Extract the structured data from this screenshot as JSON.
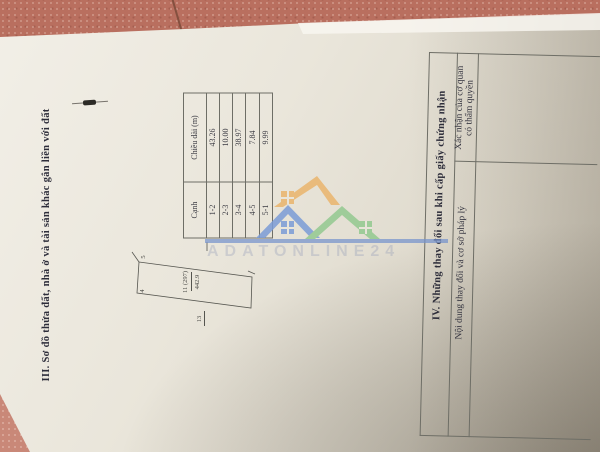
{
  "section_iii": {
    "heading": "III. Sơ đồ thửa đất, nhà ở và tài sản khác gắn liền với đất",
    "table": {
      "col_headers": [
        "Cạnh",
        "Chiều dài (m)"
      ],
      "rows": [
        [
          "1-2",
          "43.26"
        ],
        [
          "2-3",
          "10.00"
        ],
        [
          "3-4",
          "38.97"
        ],
        [
          "4-5",
          "7.84"
        ],
        [
          "5-1",
          "9.99"
        ]
      ]
    },
    "diagram": {
      "parcel_label": "11 (297)",
      "parcel_area": "442.9",
      "adjacent_parcel": "13",
      "vertex_4": "4",
      "vertex_5": "5"
    }
  },
  "section_iv": {
    "heading": "IV. Những thay đổi sau khi cấp giấy chứng nhận",
    "column_1_header": "Nội dung thay đổi và cơ sở pháp lý",
    "column_2_header_line_1": "Xác nhận của cơ quan",
    "column_2_header_line_2": "có thẩm quyền"
  },
  "watermark": {
    "text": "ADATONLINE24",
    "colors": {
      "blue": "#7b9cd6",
      "orange": "#eab56d",
      "green": "#93c990",
      "bar": "#7693cc"
    }
  },
  "colors": {
    "tile": "#b96f5f",
    "tile_corner": "#c98878",
    "paper": "#e9e5da",
    "ink": "#32323c",
    "table_line": "#6e6e66"
  }
}
